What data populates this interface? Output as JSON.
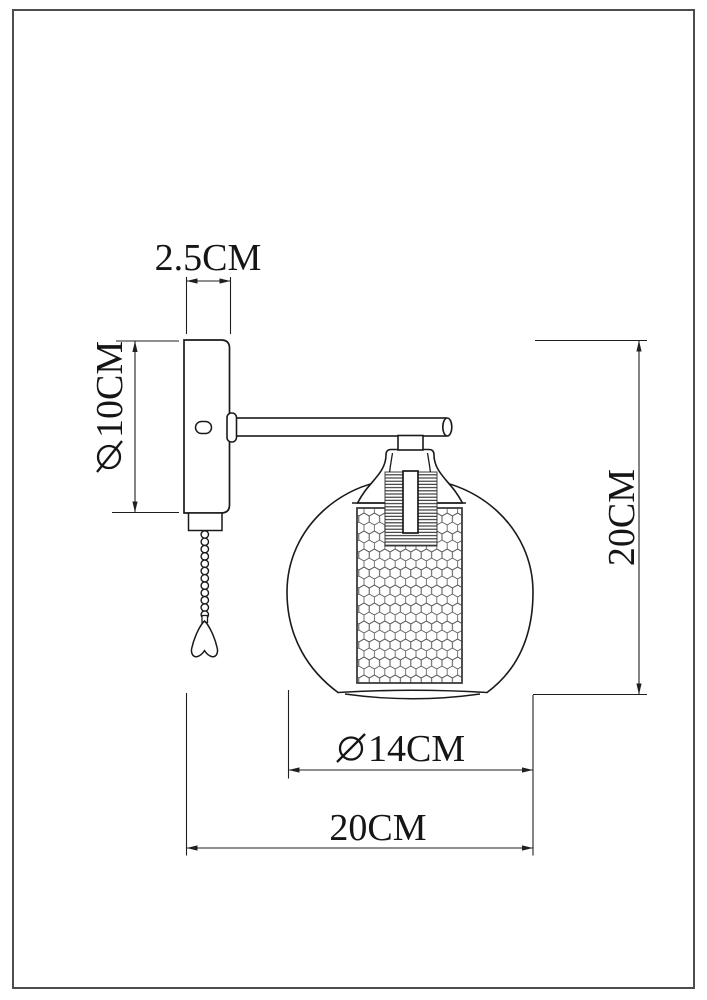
{
  "canvas": {
    "width": 707,
    "height": 1000,
    "background": "#ffffff",
    "frame_color": "#4d4d4d",
    "line_color": "#1a1a1a",
    "dimension_color": "#1f1f1f"
  },
  "figure": {
    "type": "technical-dimension-drawing",
    "subject": "wall-sconce-lamp-side-view",
    "parts": [
      "wall-mount-plate",
      "switch-button",
      "mount-plate-cap",
      "ball-pull-chain",
      "chain-pull-tassel",
      "mounting-arm",
      "socket-neck",
      "socket-bell-cap",
      "threaded-socket",
      "honeycomb-mesh-shade",
      "glass-globe-shade"
    ]
  },
  "dimensions": {
    "plate_width": {
      "label": "2.5CM",
      "symbol": "",
      "text": "2.5CM"
    },
    "plate_height": {
      "label": "∅10CM",
      "symbol": "∅",
      "text": "10CM"
    },
    "overall_height": {
      "label": "20CM",
      "symbol": "",
      "text": "20CM"
    },
    "globe_diameter": {
      "label": "∅14CM",
      "symbol": "∅",
      "text": "14CM"
    },
    "overall_width": {
      "label": "20CM",
      "symbol": "",
      "text": "20CM"
    }
  }
}
